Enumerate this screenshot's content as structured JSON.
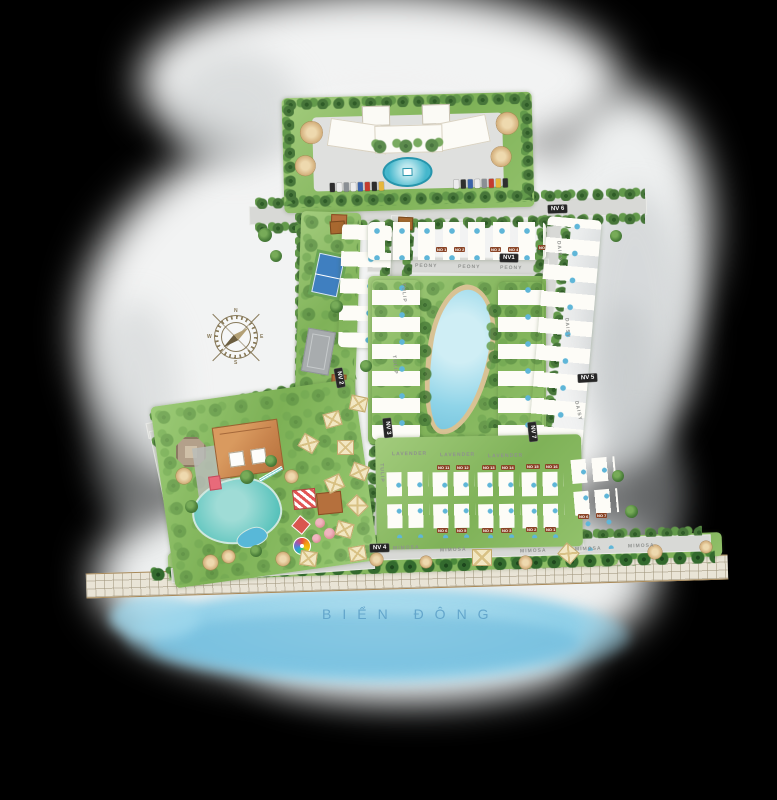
{
  "map": {
    "sea_label": "BIỂN ĐÔNG",
    "compass": {
      "n": "N",
      "e": "E",
      "s": "S",
      "w": "W"
    },
    "zones": {
      "nv1": "NV1",
      "nv2": "NV 2",
      "nv3": "NV 3",
      "nv4": "NV 4",
      "nv5": "NV 5",
      "nv6": "NV 6",
      "nv7": "NV 7"
    },
    "streets": {
      "peony": "PEONY",
      "tulip": "TULIP",
      "daisy": "DAISY",
      "lavender": "LAVENDER",
      "mimosa": "MIMOSA"
    },
    "villas": {
      "north_row": [
        "NO 1",
        "NO 2",
        "NO 3",
        "NO 4",
        "NO 5"
      ],
      "south_top_row": [
        "NO 11",
        "NO 12",
        "NO 13",
        "NO 14",
        "NO 15",
        "NO 16"
      ],
      "south_bottom_row": [
        "NO 6",
        "NO 5",
        "NO 4",
        "NO 3",
        "NO 2",
        "NO 1"
      ],
      "east_column": [
        "NO 6",
        "NO 7"
      ]
    },
    "colors": {
      "sea": "#7ec4de",
      "sea_text": "#5b9fc7",
      "green": "#85b85e",
      "road": "#d8d9d6",
      "roof": "#c9854e",
      "badge_bg": "#262626",
      "chip_bg": "#8a4426",
      "pool": "#49b8c8",
      "sand": "#d8c294"
    }
  }
}
